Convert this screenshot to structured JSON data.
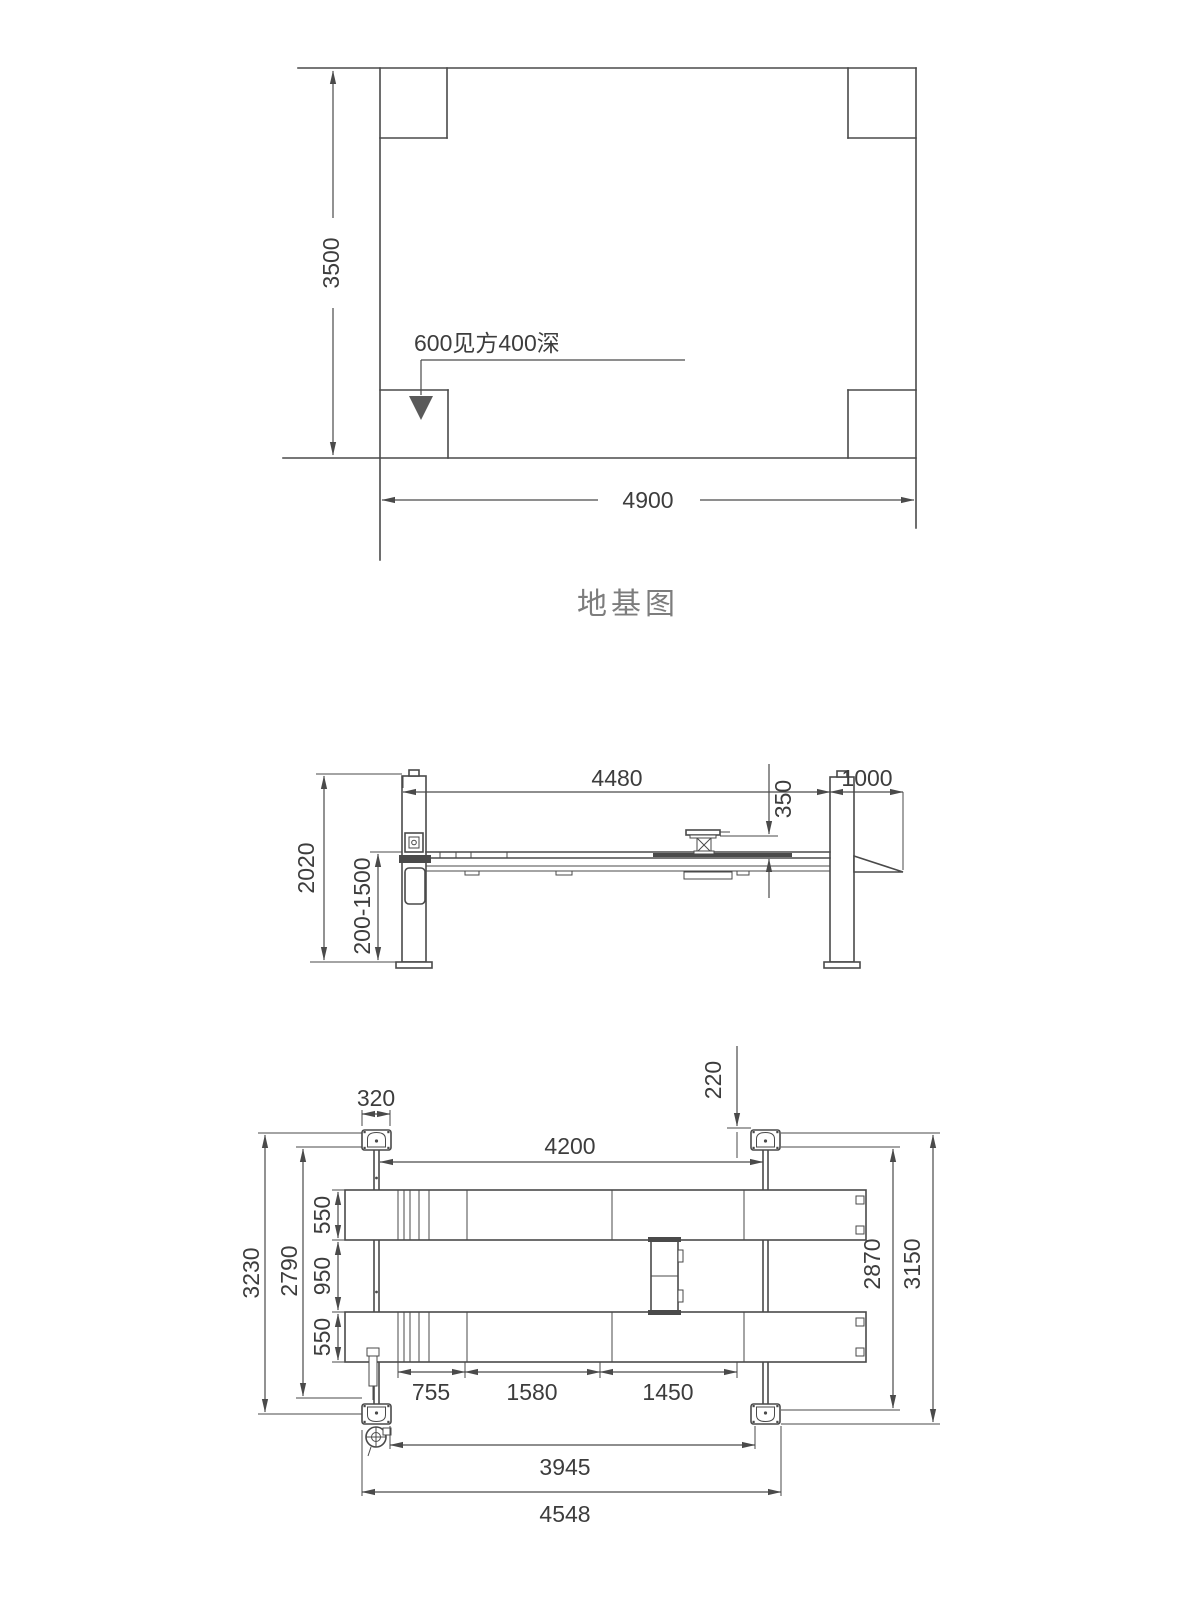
{
  "colors": {
    "line": "#4a4a4a",
    "text": "#3d3d3d",
    "title_gray": "#7d7d7d"
  },
  "foundation_plan": {
    "title": "地基图",
    "width_label": "4900",
    "height_label": "3500",
    "pit_note": "600见方400深"
  },
  "side_view": {
    "span_label": "4480",
    "ramp_label": "1000",
    "jack_height_label": "350",
    "post_height_label": "2020",
    "lift_range_label": "200-1500"
  },
  "plan_view": {
    "post_width_label": "320",
    "offset_label": "220",
    "span_label": "4200",
    "runway_top_label": "550",
    "gap_label": "950",
    "runway_bottom_label": "550",
    "outer_left_label": "3230",
    "inner_left_label": "2790",
    "inner_right_label": "2870",
    "outer_right_label": "3150",
    "seg1_label": "755",
    "seg2_label": "1580",
    "seg3_label": "1450",
    "inner_span_label": "3945",
    "outer_span_label": "4548"
  }
}
